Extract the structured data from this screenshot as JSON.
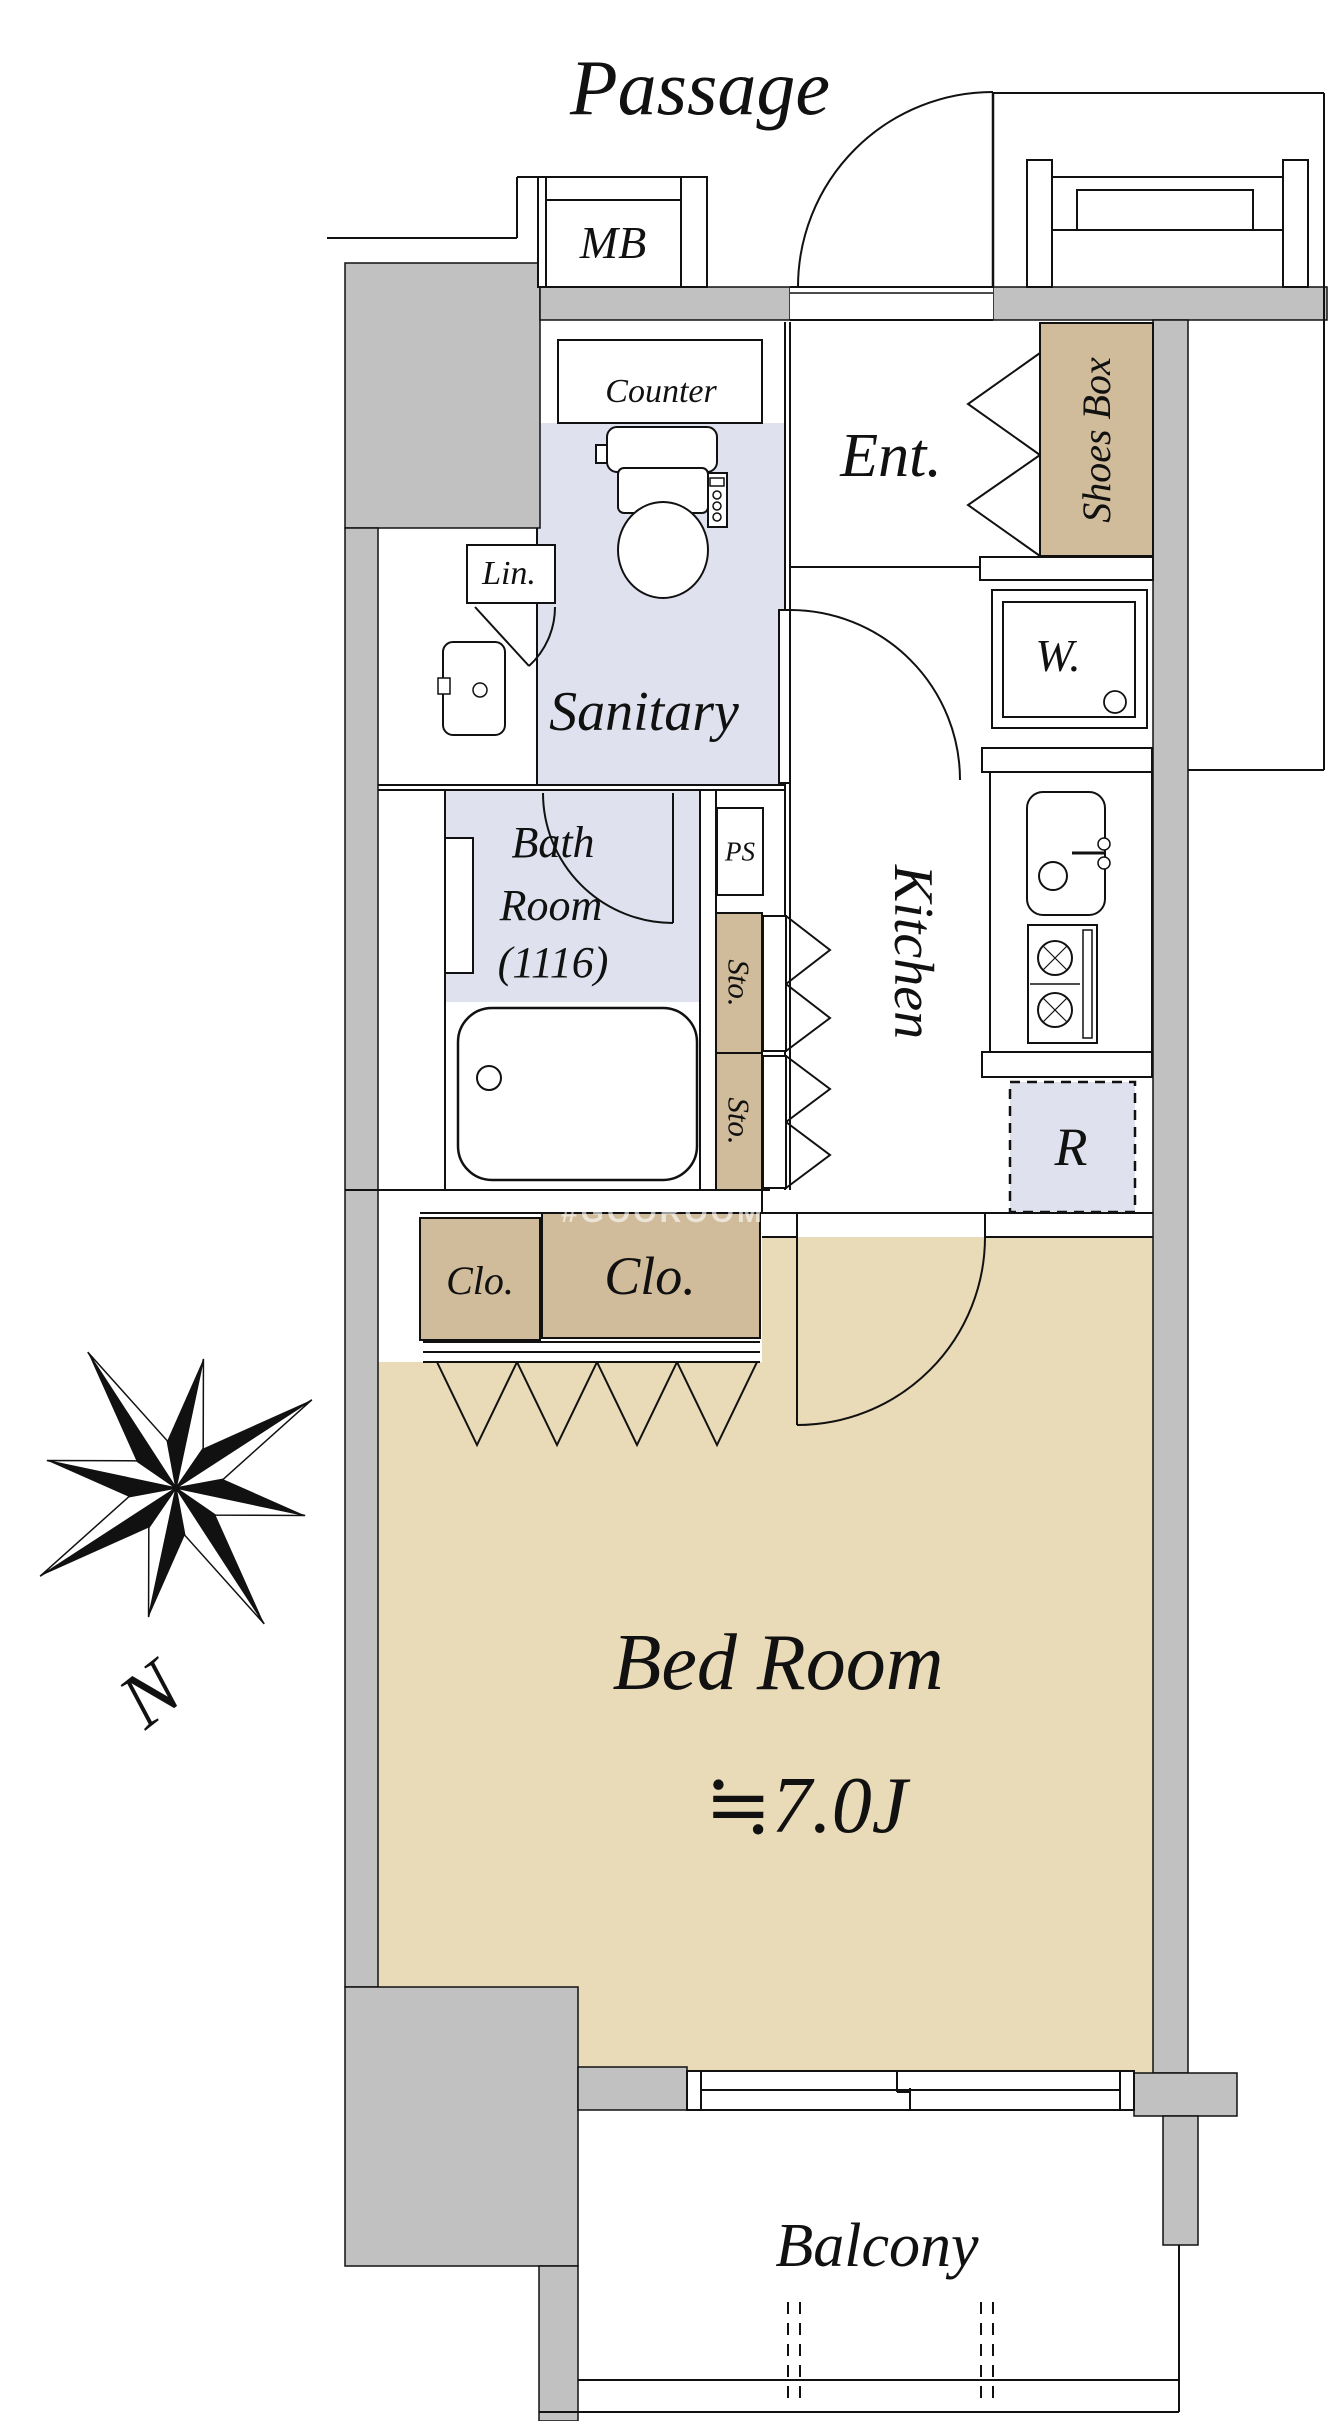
{
  "labels": {
    "passage": "Passage",
    "mb": "MB",
    "counter": "Counter",
    "entrance": "Ent.",
    "shoes_box": "Shoes Box",
    "washer": "W.",
    "linen": "Lin.",
    "sanitary": "Sanitary",
    "kitchen": "Kitchen",
    "bath_line1": "Bath",
    "bath_line2": "Room",
    "bath_line3": "(1116)",
    "pipe_space": "PS",
    "storage_upper": "Sto.",
    "storage_lower": "Sto.",
    "refrigerator": "R",
    "closet_small": "Clo.",
    "closet_large": "Clo.",
    "bedroom": "Bed Room",
    "bedroom_size": "≒7.0J",
    "balcony": "Balcony",
    "north": "N",
    "watermark": "#GOOROOM"
  },
  "colors": {
    "wall": "#c1c1c1",
    "cabinet_tan": "#d0bc9a",
    "bedroom_floor": "#e9dab8",
    "wet_area": "#dfe2ee",
    "line": "#111111"
  }
}
